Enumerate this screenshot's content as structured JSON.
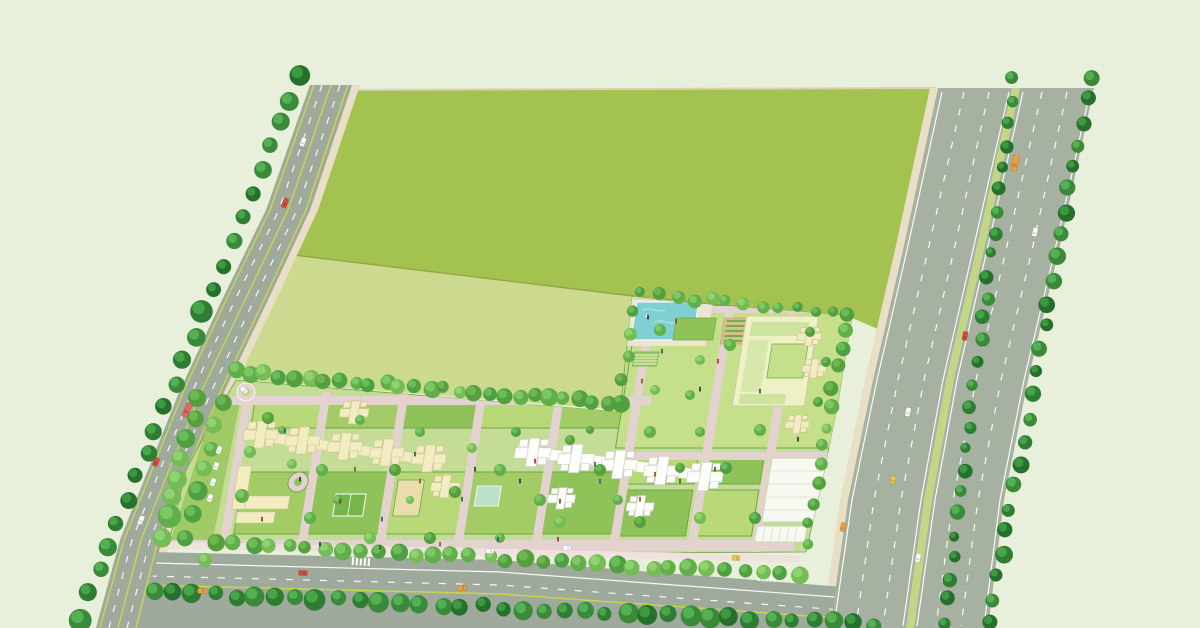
{
  "scene": {
    "kind": "township-masterplan-aerial-illustration",
    "regions": [
      "open-field",
      "left-avenue",
      "bottom-boulevard",
      "highway",
      "residential-parcel",
      "amenity-zone"
    ]
  },
  "palette": {
    "background": "#e8efdb",
    "fieldDark": "#a4c24f",
    "fieldLight": "#cbda8e",
    "fieldLine": "#94a547",
    "fieldTopEdge": "#d9d2b2",
    "sand": "#e9dfc6",
    "roadGray": "#9fa99c",
    "highwayGray": "#a7b1a2",
    "laneWhite": "#ffffff",
    "laneLime": "#c6d94e",
    "vergeGreen": "#c2d687",
    "devBase": "#c4dc96",
    "devBuffer": "#9fca65",
    "innerRoad": "#e4d2cf",
    "innerPath": "#efe2de",
    "buildingCream": "#f2ecc3",
    "buildingCreamEdge": "#cfc48e",
    "buildingWhite": "#fdfdfa",
    "buildingWhiteEdge": "#c9cdc2",
    "lawn": [
      "#b9d877",
      "#a3cc66",
      "#8fc35a",
      "#c6df8b"
    ],
    "hedge": "#6aa845",
    "courtGreen": "#76b54a",
    "sandPlay": "#e9deab",
    "poolTeal": "#7fd0d2",
    "poolRipple": "#aee2e0",
    "poolDeck": "#ebe5d1",
    "parkingWhite": "#f8f8f3",
    "clubFill": "#eef0c6",
    "clubRoof": "#cfe3a0",
    "gardenSoil": "#cfc08c",
    "gardenRow": "#76ab47",
    "treeDark": [
      "#26702e",
      "#2f7d33",
      "#3a8a39"
    ],
    "treeDarkHi": [
      "#3f9d43",
      "#4aa94a",
      "#57b457"
    ],
    "treeMix": [
      "#4f9f43",
      "#61ae4b",
      "#74bc53",
      "#569f3f"
    ],
    "treeMixHi": [
      "#6cc05b",
      "#7fcb66",
      "#92d573",
      "#6fb954"
    ],
    "carWhite": "#fafafa",
    "carRed": "#d84a3a",
    "carOrange": "#f09d3e",
    "carYellow": "#e8c93e",
    "busRed": "#e06a5a",
    "personTones": [
      "#333a4d",
      "#a23b30",
      "#2f5f8a",
      "#8a5a2f",
      "#2f6d3a"
    ]
  },
  "tree_rows": [
    {
      "name": "avenue-west-row",
      "from": [
        298,
        76
      ],
      "to": [
        80,
        618
      ],
      "n": 24,
      "r": [
        7,
        12
      ],
      "tone": "dark"
    },
    {
      "name": "parcel-top-row",
      "from": [
        236,
        372
      ],
      "to": [
        624,
        404
      ],
      "n": 27,
      "r": [
        6,
        9
      ],
      "tone": "mix"
    },
    {
      "name": "west-buffer-outer",
      "from": [
        198,
        400
      ],
      "to": [
        162,
        536
      ],
      "n": 8,
      "r": [
        8,
        12
      ],
      "tone": "mix"
    },
    {
      "name": "west-buffer-inner",
      "from": [
        222,
        402
      ],
      "to": [
        184,
        538
      ],
      "n": 7,
      "r": [
        7,
        10
      ],
      "tone": "mix"
    },
    {
      "name": "amenity-top-row",
      "from": [
        642,
        294
      ],
      "to": [
        848,
        314
      ],
      "n": 13,
      "r": [
        5,
        8
      ],
      "tone": "mix"
    },
    {
      "name": "amenity-left-row",
      "from": [
        630,
        310
      ],
      "to": [
        622,
        400
      ],
      "n": 5,
      "r": [
        5,
        7
      ],
      "tone": "mix"
    },
    {
      "name": "parcel-right-row",
      "from": [
        844,
        328
      ],
      "to": [
        806,
        544
      ],
      "n": 12,
      "r": [
        5,
        8
      ],
      "tone": "mix"
    },
    {
      "name": "boulevard-north-row",
      "from": [
        216,
        542
      ],
      "to": [
        798,
        576
      ],
      "n": 33,
      "r": [
        6,
        9
      ],
      "tone": "mix"
    },
    {
      "name": "boulevard-south-row",
      "from": [
        152,
        592
      ],
      "to": [
        876,
        624
      ],
      "n": 36,
      "r": [
        7,
        11
      ],
      "tone": "dark"
    },
    {
      "name": "highway-median-row",
      "from": [
        1014,
        80
      ],
      "to": [
        944,
        622
      ],
      "n": 26,
      "r": [
        5,
        8
      ],
      "tone": "dark"
    },
    {
      "name": "highway-east-row",
      "from": [
        1090,
        76
      ],
      "to": [
        990,
        622
      ],
      "n": 25,
      "r": [
        6,
        9
      ],
      "tone": "dark"
    }
  ],
  "single_trees": [
    [
      268,
      418,
      6
    ],
    [
      292,
      464,
      5
    ],
    [
      322,
      470,
      6
    ],
    [
      360,
      420,
      5
    ],
    [
      395,
      470,
      6
    ],
    [
      420,
      432,
      5
    ],
    [
      455,
      492,
      6
    ],
    [
      472,
      448,
      5
    ],
    [
      500,
      470,
      6
    ],
    [
      516,
      432,
      5
    ],
    [
      540,
      500,
      6
    ],
    [
      570,
      440,
      5
    ],
    [
      600,
      470,
      6
    ],
    [
      618,
      500,
      5
    ],
    [
      650,
      432,
      6
    ],
    [
      680,
      468,
      5
    ],
    [
      700,
      432,
      5
    ],
    [
      726,
      468,
      6
    ],
    [
      660,
      330,
      6
    ],
    [
      700,
      360,
      5
    ],
    [
      730,
      345,
      6
    ],
    [
      655,
      390,
      5
    ],
    [
      690,
      395,
      5
    ],
    [
      810,
      332,
      5
    ],
    [
      826,
      362,
      5
    ],
    [
      818,
      402,
      5
    ],
    [
      760,
      430,
      6
    ],
    [
      755,
      518,
      6
    ],
    [
      700,
      518,
      6
    ],
    [
      640,
      522,
      6
    ],
    [
      560,
      522,
      6
    ],
    [
      500,
      538,
      5
    ],
    [
      430,
      538,
      6
    ],
    [
      370,
      538,
      6
    ],
    [
      310,
      518,
      6
    ],
    [
      250,
      452,
      6
    ],
    [
      242,
      496,
      7
    ],
    [
      205,
      560,
      7
    ],
    [
      282,
      430,
      4
    ],
    [
      338,
      500,
      5
    ],
    [
      410,
      500,
      4
    ],
    [
      590,
      430,
      4
    ]
  ],
  "vehicles": [
    {
      "x": 303,
      "y": 142,
      "c": "carWhite",
      "l": 9,
      "a": 111
    },
    {
      "x": 285,
      "y": 203,
      "c": "carRed",
      "l": 10,
      "a": 111
    },
    {
      "x": 187,
      "y": 410,
      "c": "busRed",
      "l": 15,
      "a": 113
    },
    {
      "x": 156,
      "y": 462,
      "c": "carRed",
      "l": 9,
      "a": 113
    },
    {
      "x": 141,
      "y": 520,
      "c": "carWhite",
      "l": 9,
      "a": 114
    },
    {
      "x": 303,
      "y": 573,
      "c": "carRed",
      "l": 9,
      "a": 3
    },
    {
      "x": 202,
      "y": 591,
      "c": "carOrange",
      "l": 9,
      "a": 3
    },
    {
      "x": 462,
      "y": 588,
      "c": "carOrange",
      "l": 9,
      "a": 3
    },
    {
      "x": 567,
      "y": 548,
      "c": "carWhite",
      "l": 8,
      "a": 3
    },
    {
      "x": 490,
      "y": 551,
      "c": "carWhite",
      "l": 8,
      "a": 3
    },
    {
      "x": 736,
      "y": 558,
      "c": "carYellow",
      "l": 8,
      "a": 4
    },
    {
      "x": 1015,
      "y": 163,
      "c": "carOrange",
      "l": 16,
      "a": 101
    },
    {
      "x": 1035,
      "y": 232,
      "c": "carWhite",
      "l": 9,
      "a": 101
    },
    {
      "x": 965,
      "y": 336,
      "c": "carRed",
      "l": 9,
      "a": 101
    },
    {
      "x": 908,
      "y": 412,
      "c": "carWhite",
      "l": 9,
      "a": 102
    },
    {
      "x": 893,
      "y": 480,
      "c": "carYellow",
      "l": 8,
      "a": 102
    },
    {
      "x": 843,
      "y": 527,
      "c": "carOrange",
      "l": 9,
      "a": 102
    },
    {
      "x": 918,
      "y": 558,
      "c": "carWhite",
      "l": 9,
      "a": 102
    },
    {
      "x": 219,
      "y": 450,
      "c": "carWhite",
      "l": 8,
      "a": 110
    },
    {
      "x": 216,
      "y": 466,
      "c": "carWhite",
      "l": 8,
      "a": 110
    },
    {
      "x": 213,
      "y": 482,
      "c": "carWhite",
      "l": 8,
      "a": 110
    },
    {
      "x": 210,
      "y": 498,
      "c": "carWhite",
      "l": 8,
      "a": 110
    },
    {
      "x": 244,
      "y": 390,
      "c": "carWhite",
      "l": 8,
      "a": 40
    }
  ],
  "people": [
    [
      300,
      480
    ],
    [
      340,
      502
    ],
    [
      382,
      520
    ],
    [
      420,
      482
    ],
    [
      462,
      500
    ],
    [
      520,
      482
    ],
    [
      560,
      502
    ],
    [
      600,
      482
    ],
    [
      640,
      500
    ],
    [
      680,
      482
    ],
    [
      700,
      390
    ],
    [
      718,
      362
    ],
    [
      662,
      352
    ],
    [
      642,
      382
    ],
    [
      760,
      392
    ],
    [
      798,
      440
    ],
    [
      558,
      540
    ],
    [
      498,
      540
    ],
    [
      440,
      545
    ],
    [
      380,
      548
    ],
    [
      320,
      545
    ],
    [
      262,
      520
    ],
    [
      285,
      432
    ],
    [
      355,
      470
    ],
    [
      415,
      455
    ],
    [
      475,
      470
    ],
    [
      535,
      462
    ],
    [
      595,
      465
    ],
    [
      655,
      475
    ],
    [
      715,
      470
    ],
    [
      648,
      318
    ],
    [
      676,
      322
    ]
  ],
  "buildings": {
    "cream_towers": [
      [
        255,
        434
      ],
      [
        298,
        440
      ],
      [
        341,
        446
      ],
      [
        384,
        452
      ],
      [
        427,
        458
      ]
    ],
    "cream_extra_towers": [
      [
        345,
        412
      ],
      [
        448,
        486
      ]
    ],
    "cream_small_towers": [
      [
        788,
        336
      ],
      [
        798,
        368
      ],
      [
        790,
        424
      ]
    ],
    "cream_bar": [
      239,
      434,
      443,
      462,
      9
    ],
    "sw_block": [
      [
        238,
        496,
        56,
        13
      ],
      [
        244,
        512,
        38,
        11
      ],
      [
        238,
        466,
        13,
        43
      ]
    ],
    "white_towers": [
      [
        530,
        452
      ],
      [
        574,
        458
      ],
      [
        618,
        464
      ],
      [
        662,
        470
      ],
      [
        706,
        476
      ]
    ],
    "white_lower_towers": [
      [
        566,
        498
      ],
      [
        646,
        506
      ]
    ],
    "white_bar": [
      514,
      450,
      722,
      478,
      10
    ]
  },
  "courtyards": [
    [
      244,
      402,
      66,
      26,
      0
    ],
    [
      318,
      402,
      70,
      26,
      1
    ],
    [
      396,
      402,
      70,
      26,
      2
    ],
    [
      474,
      402,
      70,
      26,
      0
    ],
    [
      552,
      402,
      66,
      26,
      1
    ],
    [
      244,
      472,
      66,
      62,
      1
    ],
    [
      318,
      472,
      70,
      62,
      2
    ],
    [
      396,
      472,
      70,
      62,
      0
    ],
    [
      474,
      472,
      70,
      62,
      1
    ],
    [
      552,
      472,
      70,
      62,
      2
    ],
    [
      630,
      458,
      66,
      26,
      0
    ],
    [
      704,
      458,
      58,
      26,
      2
    ],
    [
      630,
      490,
      66,
      46,
      2
    ],
    [
      704,
      490,
      58,
      46,
      0
    ],
    [
      612,
      306,
      242,
      142,
      3
    ]
  ]
}
